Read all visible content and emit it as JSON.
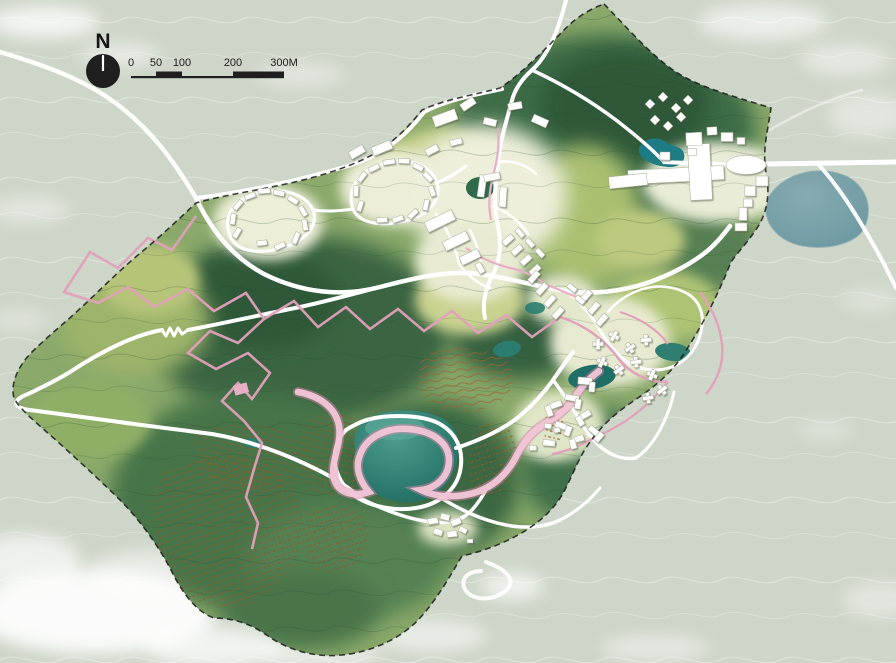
{
  "map": {
    "kind": "landscape-masterplan-site-plan",
    "compass": {
      "label": "N"
    },
    "scale_bar": {
      "labels": [
        "0",
        "50",
        "100",
        "200",
        "300M"
      ],
      "values_m": [
        0,
        50,
        100,
        200,
        300
      ],
      "unit": "M"
    }
  },
  "colors": {
    "outside_terrain": "#cdd6c8",
    "cloud_white": "#ffffff",
    "site_base_green": "#8aa96a",
    "forest_dark_green": "#35613e",
    "meadow_yellow_green": "#c6d08b",
    "plaza_cream": "#edefda",
    "lake_teal": "#2e8578",
    "east_lake_blue": "#78a1a8",
    "road_white": "#ffffff",
    "trail_pink": "#e2a0bb",
    "ribbon_pink": "#f2c6d7",
    "orchard_brown": "#8f5a2b",
    "boundary_black": "#1c1c1c",
    "building_white": "#ffffff"
  },
  "features": {
    "water_bodies": [
      "central-lake",
      "east-lake",
      "hotel-pond",
      "mid-pond-west",
      "mid-pond-central",
      "mid-pond-east",
      "north-cluster-pond",
      "orchard-pond"
    ],
    "building_clusters": [
      "northwest-villa-loop-west",
      "northwest-villa-loop-east",
      "north-central-village",
      "central-terrace-rows",
      "hillside-star-villas",
      "east-resort-complex",
      "northeast-huts",
      "southeast-courtyard-village",
      "south-hamlet"
    ],
    "paths": [
      "perimeter-road",
      "main-loop-road",
      "lake-ring-road",
      "mountain-zigzag-trail",
      "pink-ribbon-loop"
    ],
    "vegetation": [
      "terraced-orchards",
      "contour-forest",
      "dotted-orchard-rows"
    ]
  },
  "map_objects": {
    "buildings": [
      [
        237,
        233,
        11,
        5,
        -60
      ],
      [
        233,
        219,
        11,
        5,
        -82
      ],
      [
        238,
        205,
        11,
        5,
        -48
      ],
      [
        250,
        196,
        11,
        5,
        -20
      ],
      [
        264,
        191,
        12,
        5,
        -4
      ],
      [
        279,
        193,
        11,
        5,
        12
      ],
      [
        293,
        200,
        11,
        5,
        32
      ],
      [
        303,
        211,
        11,
        5,
        58
      ],
      [
        305,
        225,
        11,
        5,
        82
      ],
      [
        296,
        238,
        12,
        5,
        112
      ],
      [
        280,
        246,
        11,
        5,
        155
      ],
      [
        262,
        243,
        10,
        5,
        172
      ],
      [
        360,
        206,
        11,
        5,
        -72
      ],
      [
        356,
        191,
        11,
        5,
        -86
      ],
      [
        362,
        177,
        11,
        5,
        -52
      ],
      [
        374,
        168,
        11,
        5,
        -26
      ],
      [
        389,
        162,
        12,
        5,
        -8
      ],
      [
        404,
        161,
        11,
        5,
        4
      ],
      [
        418,
        167,
        11,
        5,
        26
      ],
      [
        428,
        177,
        11,
        5,
        46
      ],
      [
        432,
        191,
        11,
        5,
        70
      ],
      [
        426,
        205,
        11,
        5,
        102
      ],
      [
        413,
        214,
        11,
        5,
        136
      ],
      [
        398,
        219,
        11,
        5,
        160
      ],
      [
        382,
        220,
        11,
        5,
        176
      ],
      [
        382,
        148,
        20,
        9,
        -22
      ],
      [
        357,
        152,
        16,
        8,
        -30
      ],
      [
        445,
        118,
        24,
        11,
        -20
      ],
      [
        468,
        104,
        15,
        8,
        -34
      ],
      [
        490,
        122,
        13,
        7,
        14
      ],
      [
        515,
        106,
        14,
        7,
        -10
      ],
      [
        540,
        121,
        16,
        8,
        24
      ],
      [
        432,
        150,
        13,
        7,
        -28
      ],
      [
        456,
        142,
        12,
        6,
        -14
      ],
      [
        482,
        186,
        7,
        22,
        8
      ],
      [
        492,
        177,
        16,
        7,
        -12
      ],
      [
        503,
        197,
        7,
        20,
        4
      ],
      [
        440,
        221,
        30,
        11,
        -26
      ],
      [
        456,
        241,
        26,
        10,
        -26
      ],
      [
        470,
        257,
        20,
        9,
        -26
      ],
      [
        480,
        268,
        11,
        6,
        60
      ],
      [
        508,
        240,
        12,
        6,
        -42
      ],
      [
        517,
        250,
        12,
        6,
        -42
      ],
      [
        526,
        260,
        12,
        6,
        -42
      ],
      [
        535,
        270,
        12,
        6,
        -42
      ],
      [
        520,
        233,
        10,
        5,
        48
      ],
      [
        530,
        243,
        10,
        5,
        48
      ],
      [
        540,
        253,
        10,
        5,
        48
      ],
      [
        534,
        277,
        13,
        6,
        -48
      ],
      [
        542,
        289,
        13,
        6,
        -48
      ],
      [
        550,
        301,
        13,
        6,
        -48
      ],
      [
        558,
        313,
        13,
        6,
        -48
      ],
      [
        586,
        296,
        13,
        6,
        -48
      ],
      [
        594,
        308,
        13,
        6,
        -48
      ],
      [
        602,
        320,
        13,
        6,
        -48
      ],
      [
        572,
        288,
        10,
        5,
        40
      ],
      [
        580,
        300,
        10,
        5,
        40
      ],
      [
        676,
        175,
        96,
        14,
        -3
      ],
      [
        700,
        172,
        22,
        56,
        -3
      ],
      [
        694,
        139,
        16,
        13,
        -3
      ],
      [
        712,
        131,
        10,
        8,
        -3
      ],
      [
        628,
        181,
        38,
        12,
        -6
      ],
      [
        727,
        137,
        12,
        9,
        0
      ],
      [
        741,
        141,
        8,
        7,
        0
      ],
      [
        762,
        181,
        12,
        10,
        0
      ],
      [
        750,
        191,
        11,
        10,
        0
      ],
      [
        748,
        203,
        9,
        8,
        0
      ],
      [
        743,
        214,
        8,
        13,
        0
      ],
      [
        741,
        227,
        12,
        8,
        0
      ],
      [
        692,
        152,
        9,
        7,
        0
      ],
      [
        665,
        156,
        10,
        8,
        0
      ],
      [
        555,
        405,
        14,
        6,
        -20
      ],
      [
        549,
        411,
        6,
        11,
        -20
      ],
      [
        572,
        398,
        14,
        6,
        10
      ],
      [
        578,
        404,
        6,
        10,
        10
      ],
      [
        585,
        415,
        12,
        6,
        -30
      ],
      [
        580,
        421,
        6,
        10,
        -30
      ],
      [
        562,
        426,
        14,
        6,
        20
      ],
      [
        568,
        431,
        6,
        10,
        20
      ],
      [
        578,
        439,
        12,
        6,
        -15
      ],
      [
        573,
        444,
        6,
        10,
        -15
      ],
      [
        594,
        431,
        12,
        6,
        40
      ],
      [
        599,
        437,
        6,
        10,
        40
      ],
      [
        549,
        443,
        12,
        6,
        5
      ],
      [
        585,
        381,
        14,
        7,
        5
      ],
      [
        592,
        387,
        6,
        10,
        5
      ],
      [
        433,
        521,
        10,
        6,
        -10
      ],
      [
        445,
        517,
        9,
        6,
        14
      ],
      [
        456,
        522,
        10,
        6,
        -22
      ],
      [
        438,
        532,
        9,
        6,
        18
      ],
      [
        452,
        534,
        10,
        6,
        -6
      ],
      [
        463,
        530,
        8,
        5,
        28
      ],
      [
        470,
        541,
        6,
        4,
        0
      ],
      [
        548,
        426,
        7,
        5,
        10
      ],
      [
        557,
        430,
        6,
        5,
        -15
      ],
      [
        533,
        448,
        7,
        5,
        0
      ]
    ],
    "star_villas": [
      [
        598,
        344
      ],
      [
        614,
        336
      ],
      [
        630,
        348
      ],
      [
        646,
        340
      ],
      [
        602,
        362
      ],
      [
        619,
        370
      ],
      [
        636,
        362
      ],
      [
        652,
        375
      ],
      [
        662,
        390
      ],
      [
        648,
        398
      ]
    ],
    "diamond_huts": [
      [
        650,
        104
      ],
      [
        663,
        97
      ],
      [
        676,
        108
      ],
      [
        688,
        100
      ],
      [
        655,
        120
      ],
      [
        668,
        126
      ],
      [
        681,
        117
      ]
    ]
  }
}
